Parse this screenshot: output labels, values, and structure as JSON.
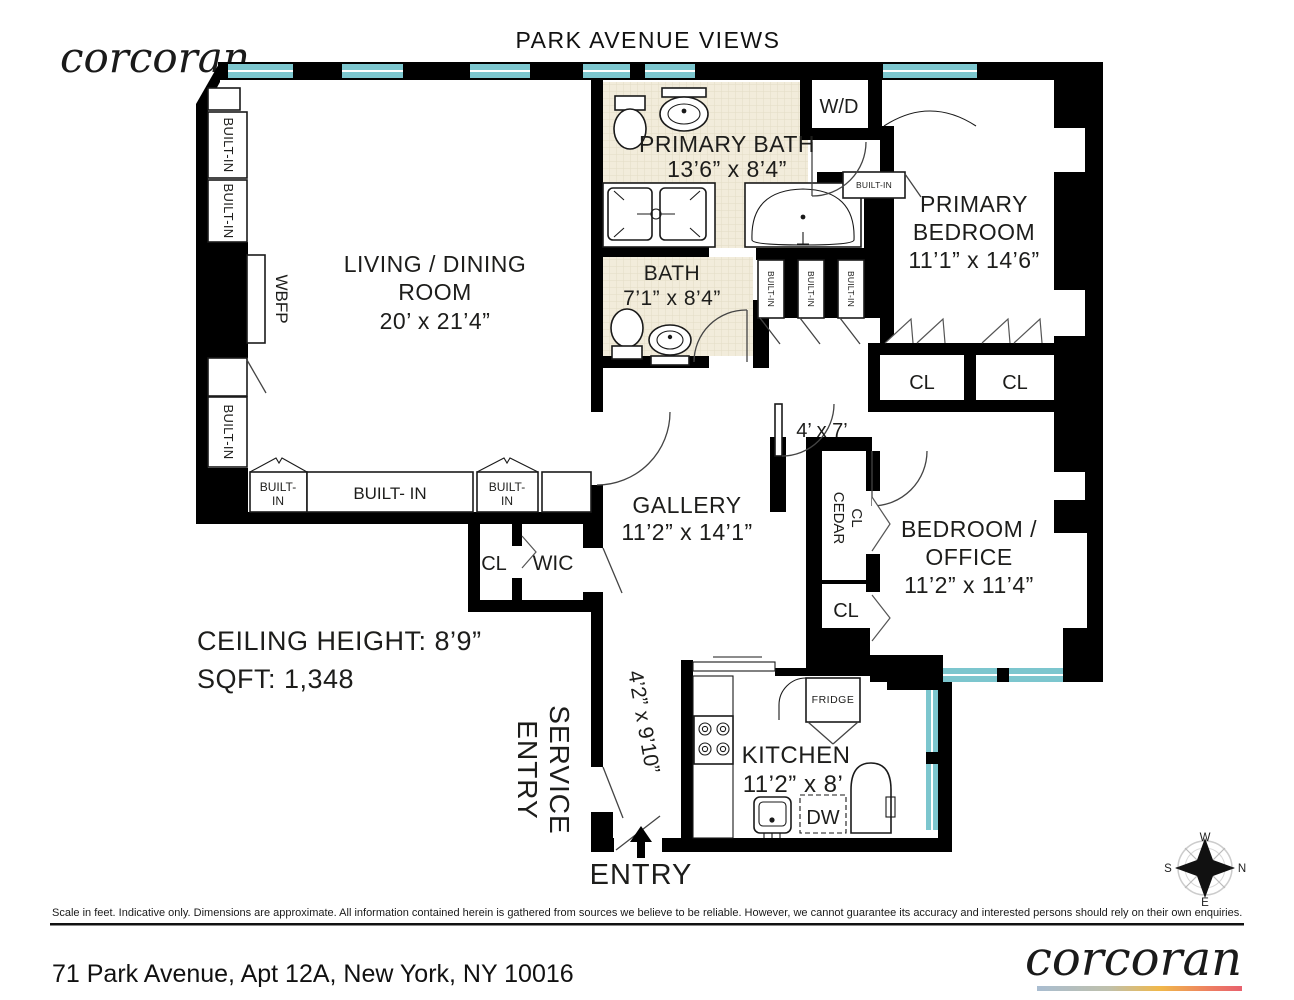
{
  "header": {
    "brand": "corcoran",
    "title": "PARK AVENUE VIEWS"
  },
  "info": {
    "ceiling": "CEILING HEIGHT: 8’9”",
    "sqft": "SQFT: 1,348"
  },
  "rooms": {
    "living": {
      "l1": "LIVING / DINING",
      "l2": "ROOM",
      "dims": "20’ x 21’4”"
    },
    "primary_bath": {
      "name": "PRIMARY BATH",
      "dims": "13’6” x 8’4”"
    },
    "bath": {
      "name": "BATH",
      "dims": "7’1” x 8’4”"
    },
    "primary_bedroom": {
      "l1": "PRIMARY",
      "l2": "BEDROOM",
      "dims": "11’1” x 14’6”"
    },
    "gallery": {
      "name": "GALLERY",
      "dims": "11’2” x 14’1”"
    },
    "bedroom_office": {
      "l1": "BEDROOM /",
      "l2": "OFFICE",
      "dims": "11’2” x 11’4”"
    },
    "kitchen": {
      "name": "KITCHEN",
      "dims": "11’2” x 8’"
    },
    "hall": {
      "dims": "4’ x 7’"
    },
    "entry_hall": {
      "dims": "4’2” x 9’10”"
    }
  },
  "labels": {
    "wd": "W/D",
    "wbfp": "WBFP",
    "built_in": "BUILT-IN",
    "built_in_l1": "BUILT-",
    "built_in_l2": "IN",
    "built_in_wide": "BUILT- IN",
    "cl": "CL",
    "wic": "WIC",
    "cedar_l1": "CEDAR",
    "cedar_l2": "CL",
    "fridge": "FRIDGE",
    "dw": "DW",
    "service_l1": "SERVICE",
    "service_l2": "ENTRY",
    "entry": "ENTRY"
  },
  "compass": {
    "n": "N",
    "s": "S",
    "e": "E",
    "w": "W"
  },
  "footer": {
    "disclaimer": "Scale in feet. Indicative only. Dimensions are approximate. All information contained herein is gathered from sources we believe to be reliable. However, we cannot guarantee its accuracy and interested persons should rely on their own enquiries.",
    "address": "71 Park Avenue, Apt 12A, New York, NY 10016",
    "brand": "corcoran"
  },
  "colors": {
    "wall": "#000000",
    "window": "#7cc6ce",
    "bath_floor": "#f2ecdb",
    "text": "#1d1d1b",
    "logo_gradient": [
      "#a9bdd1",
      "#f0b84a",
      "#e8616e"
    ]
  }
}
